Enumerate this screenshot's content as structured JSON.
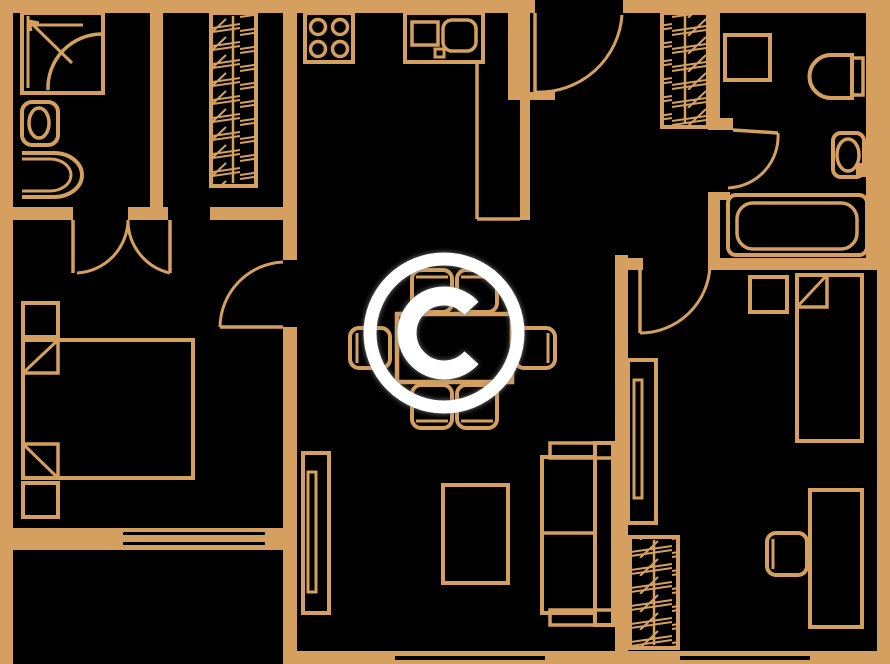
{
  "meta": {
    "watermark_letter": "C"
  },
  "colors": {
    "background": "#000000",
    "wall": "#D5A05F",
    "furniture": "#D5A05F",
    "door": "#D5A05F",
    "watermark": "#FFFFFF",
    "watermark_shadow": "#8A8A8A"
  },
  "canvas": {
    "w": 890,
    "h": 664
  },
  "walls": [
    {
      "name": "wall-top-left",
      "x": 0,
      "y": 0,
      "w": 535,
      "h": 13
    },
    {
      "name": "wall-top-right",
      "x": 623,
      "y": 0,
      "w": 267,
      "h": 13
    },
    {
      "name": "wall-left",
      "x": 0,
      "y": 0,
      "w": 13,
      "h": 664
    },
    {
      "name": "wall-right",
      "x": 877,
      "y": 0,
      "w": 13,
      "h": 664
    },
    {
      "name": "wall-right-bath-inner",
      "x": 866,
      "y": 13,
      "w": 11,
      "h": 257
    },
    {
      "name": "wall-bottom",
      "x": 297,
      "y": 651,
      "w": 593,
      "h": 13
    },
    {
      "name": "wall-bath-closet-divider",
      "x": 150,
      "y": 0,
      "w": 13,
      "h": 208
    },
    {
      "name": "wall-hall-a",
      "x": 13,
      "y": 207,
      "w": 60,
      "h": 13
    },
    {
      "name": "wall-hall-b",
      "x": 128,
      "y": 207,
      "w": 40,
      "h": 13
    },
    {
      "name": "wall-hall-c",
      "x": 210,
      "y": 207,
      "w": 87,
      "h": 13
    },
    {
      "name": "wall-kitchen-left",
      "x": 283,
      "y": 13,
      "w": 14,
      "h": 247
    },
    {
      "name": "wall-bedroom-living",
      "x": 283,
      "y": 327,
      "w": 14,
      "h": 213
    },
    {
      "name": "wall-bedroom-bottom",
      "x": 0,
      "y": 528,
      "w": 297,
      "h": 22
    },
    {
      "name": "wall-balcony-right",
      "x": 283,
      "y": 550,
      "w": 14,
      "h": 114
    },
    {
      "name": "wall-entry-pillar",
      "x": 508,
      "y": 13,
      "w": 22,
      "h": 85
    },
    {
      "name": "wall-kitchen-right",
      "x": 520,
      "y": 13,
      "w": 10,
      "h": 207
    },
    {
      "name": "wall-entry-stub",
      "x": 508,
      "y": 92,
      "w": 47,
      "h": 8
    },
    {
      "name": "wall-hall-bath-upper",
      "x": 708,
      "y": 13,
      "w": 12,
      "h": 114
    },
    {
      "name": "wall-hall-bath-lower",
      "x": 708,
      "y": 192,
      "w": 12,
      "h": 78
    },
    {
      "name": "wall-bath-partition-stub",
      "x": 708,
      "y": 118,
      "w": 25,
      "h": 12
    },
    {
      "name": "wall-bath-notch",
      "x": 720,
      "y": 192,
      "w": 10,
      "h": 8
    },
    {
      "name": "wall-rbedroom-top",
      "x": 710,
      "y": 258,
      "w": 167,
      "h": 12
    },
    {
      "name": "wall-living-rbedroom",
      "x": 615,
      "y": 255,
      "w": 13,
      "h": 409
    },
    {
      "name": "wall-rbedroom-jamb",
      "x": 615,
      "y": 258,
      "w": 28,
      "h": 12
    },
    {
      "name": "wall-bath-right-stub",
      "x": 856,
      "y": 163,
      "w": 21,
      "h": 14
    }
  ],
  "window_slits": [
    {
      "name": "window-living",
      "x": 395,
      "y": 656,
      "w": 150,
      "h": 4
    },
    {
      "name": "window-rbedroom",
      "x": 680,
      "y": 656,
      "w": 130,
      "h": 4
    },
    {
      "name": "window-balcony-upper",
      "x": 123,
      "y": 532,
      "w": 142,
      "h": 3
    },
    {
      "name": "window-balcony-lower",
      "x": 123,
      "y": 542,
      "w": 142,
      "h": 3
    }
  ],
  "doors": [
    {
      "name": "door-bathroom-left",
      "leaf": [
        73,
        220,
        73,
        273
      ],
      "arc": "M 77,273 A 54 54 0 0 0 128,220"
    },
    {
      "name": "door-closet-nook",
      "leaf": [
        170,
        220,
        170,
        273
      ],
      "arc": "M 170,273 A 54 54 0 0 1 128,220"
    },
    {
      "name": "door-bedroom-left",
      "leaf": [
        220,
        327,
        283,
        327
      ],
      "arc": "M 283,262 A 66 66 0 0 0 220,327"
    },
    {
      "name": "door-entry",
      "leaf": [
        535,
        13,
        535,
        92
      ],
      "arc": "M 536,92 A 83 83 0 0 0 622,15"
    },
    {
      "name": "door-bathroom-right",
      "leaf": [
        733,
        130,
        778,
        133
      ],
      "arc": "M 778,133 A 52 52 0 0 1 728,188"
    },
    {
      "name": "door-bedroom-right",
      "leaf": [
        640,
        270,
        640,
        333
      ],
      "arc": "M 640,333 A 70 70 0 0 0 710,266"
    }
  ],
  "furniture": [
    {
      "name": "shower",
      "type": "rect",
      "x": 22,
      "y": 13,
      "w": 81,
      "h": 80
    },
    {
      "name": "shower-glass-left",
      "type": "line",
      "x1": 28,
      "y1": 16,
      "x2": 28,
      "y2": 88,
      "sw": 3
    },
    {
      "name": "shower-glass-top",
      "type": "line",
      "x1": 28,
      "y1": 25,
      "x2": 83,
      "y2": 25,
      "sw": 3
    },
    {
      "name": "shower-arrow",
      "type": "line",
      "x1": 29,
      "y1": 21,
      "x2": 72,
      "y2": 63,
      "sw": 3
    },
    {
      "name": "shower-arrow-barb-1",
      "type": "line",
      "x1": 29,
      "y1": 21,
      "x2": 39,
      "y2": 23,
      "sw": 3
    },
    {
      "name": "shower-arrow-barb-2",
      "type": "line",
      "x1": 29,
      "y1": 21,
      "x2": 31,
      "y2": 31,
      "sw": 3
    },
    {
      "name": "shower-door-arc",
      "type": "path",
      "d": "M 102,34 A 54 54 0 0 0 48,90",
      "sw": 3.5
    },
    {
      "name": "toilet-left",
      "type": "rect",
      "x": 22,
      "y": 102,
      "w": 36,
      "h": 43,
      "rx": 10
    },
    {
      "name": "toilet-left-bowl",
      "type": "ellipse",
      "cx": 39,
      "cy": 123,
      "rx": 10,
      "ry": 15,
      "sw": 3.5
    },
    {
      "name": "sink-left",
      "type": "path",
      "d": "M 22,153 h 32 a 28 22 0 0 1 0 44 h -32",
      "sw": 4
    },
    {
      "name": "sink-left-inner",
      "type": "path",
      "d": "M 22,159 h 28 a 21 16 0 0 1 0 32 h -28",
      "sw": 3
    },
    {
      "name": "wardrobe-hall-left",
      "type": "hrect",
      "x": 211,
      "y": 13,
      "w": 45,
      "h": 173
    },
    {
      "name": "wardrobe-hall-left-rod",
      "type": "line",
      "x1": 233,
      "y1": 16,
      "x2": 233,
      "y2": 183,
      "sw": 2.5
    },
    {
      "name": "wardrobe-entry",
      "type": "hrect",
      "x": 662,
      "y": 13,
      "w": 46,
      "h": 114
    },
    {
      "name": "wardrobe-entry-rod",
      "type": "line",
      "x1": 685,
      "y1": 15,
      "x2": 685,
      "y2": 124,
      "sw": 2.5
    },
    {
      "name": "wardrobe-rbedroom",
      "type": "hrect",
      "x": 630,
      "y": 537,
      "w": 48,
      "h": 111
    },
    {
      "name": "wardrobe-rbedroom-rod",
      "type": "line",
      "x1": 654,
      "y1": 540,
      "x2": 654,
      "y2": 645,
      "sw": 2.5
    },
    {
      "name": "stove",
      "type": "rect",
      "x": 305,
      "y": 13,
      "w": 48,
      "h": 49
    },
    {
      "name": "stove-burner-1",
      "type": "circle",
      "cx": 318,
      "cy": 27,
      "r": 7.5,
      "sw": 3.5
    },
    {
      "name": "stove-burner-2",
      "type": "circle",
      "cx": 340,
      "cy": 27,
      "r": 7.5,
      "sw": 3.5
    },
    {
      "name": "stove-burner-3",
      "type": "circle",
      "cx": 318,
      "cy": 49,
      "r": 7.5,
      "sw": 3.5
    },
    {
      "name": "stove-burner-4",
      "type": "circle",
      "cx": 340,
      "cy": 49,
      "r": 7.5,
      "sw": 3.5
    },
    {
      "name": "kitchen-sink-unit",
      "type": "rect",
      "x": 405,
      "y": 13,
      "w": 78,
      "h": 49
    },
    {
      "name": "kitchen-counter-square",
      "type": "rect",
      "x": 412,
      "y": 22,
      "w": 26,
      "h": 23,
      "sw": 3.5
    },
    {
      "name": "kitchen-sink-basin",
      "type": "rect",
      "x": 443,
      "y": 20,
      "w": 33,
      "h": 31,
      "rx": 9,
      "sw": 3.5
    },
    {
      "name": "kitchen-sink-tap",
      "type": "rect",
      "x": 435,
      "y": 49,
      "w": 9,
      "h": 8,
      "sw": 3
    },
    {
      "name": "kitchen-counter-edge-v",
      "type": "line",
      "x1": 477,
      "y1": 62,
      "x2": 477,
      "y2": 219,
      "sw": 3.5
    },
    {
      "name": "kitchen-counter-edge-h",
      "type": "line",
      "x1": 477,
      "y1": 219,
      "x2": 520,
      "y2": 219,
      "sw": 3.5
    },
    {
      "name": "dining-table",
      "type": "rect",
      "x": 397,
      "y": 314,
      "w": 115,
      "h": 68,
      "sw": 4.5
    },
    {
      "name": "chair-top-1",
      "type": "rect",
      "x": 412,
      "y": 270,
      "w": 40,
      "h": 42,
      "rx": 9
    },
    {
      "name": "chair-top-1-back",
      "type": "line",
      "x1": 416,
      "y1": 277,
      "x2": 448,
      "y2": 277,
      "sw": 3
    },
    {
      "name": "chair-top-2",
      "type": "rect",
      "x": 457,
      "y": 270,
      "w": 40,
      "h": 42,
      "rx": 9
    },
    {
      "name": "chair-top-2-back",
      "type": "line",
      "x1": 461,
      "y1": 277,
      "x2": 493,
      "y2": 277,
      "sw": 3
    },
    {
      "name": "chair-bottom-1",
      "type": "rect",
      "x": 412,
      "y": 385,
      "w": 40,
      "h": 43,
      "rx": 9
    },
    {
      "name": "chair-bottom-1-back",
      "type": "line",
      "x1": 416,
      "y1": 421,
      "x2": 448,
      "y2": 421,
      "sw": 3
    },
    {
      "name": "chair-bottom-2",
      "type": "rect",
      "x": 457,
      "y": 385,
      "w": 40,
      "h": 43,
      "rx": 9
    },
    {
      "name": "chair-bottom-2-back",
      "type": "line",
      "x1": 461,
      "y1": 421,
      "x2": 493,
      "y2": 421,
      "sw": 3
    },
    {
      "name": "chair-left",
      "type": "rect",
      "x": 350,
      "y": 328,
      "w": 40,
      "h": 40,
      "rx": 9
    },
    {
      "name": "chair-left-back",
      "type": "line",
      "x1": 357,
      "y1": 333,
      "x2": 357,
      "y2": 363,
      "sw": 3
    },
    {
      "name": "chair-right",
      "type": "rect",
      "x": 515,
      "y": 328,
      "w": 40,
      "h": 40,
      "rx": 9
    },
    {
      "name": "chair-right-back",
      "type": "line",
      "x1": 548,
      "y1": 333,
      "x2": 548,
      "y2": 363,
      "sw": 3
    },
    {
      "name": "tv-stand",
      "type": "rect",
      "x": 303,
      "y": 453,
      "w": 26,
      "h": 160
    },
    {
      "name": "tv",
      "type": "rect",
      "x": 308,
      "y": 472,
      "w": 8,
      "h": 120,
      "sw": 3
    },
    {
      "name": "coffee-table",
      "type": "rect",
      "x": 443,
      "y": 485,
      "w": 65,
      "h": 98
    },
    {
      "name": "sofa-back",
      "type": "rect",
      "x": 595,
      "y": 443,
      "w": 18,
      "h": 182
    },
    {
      "name": "sofa-arm-top",
      "type": "rect",
      "x": 550,
      "y": 443,
      "w": 63,
      "h": 15,
      "sw": 3.5
    },
    {
      "name": "sofa-arm-bottom",
      "type": "rect",
      "x": 550,
      "y": 610,
      "w": 63,
      "h": 15,
      "sw": 3.5
    },
    {
      "name": "sofa-seat",
      "type": "rect",
      "x": 542,
      "y": 457,
      "w": 53,
      "h": 156
    },
    {
      "name": "sofa-seat-divider",
      "type": "line",
      "x1": 542,
      "y1": 533,
      "x2": 595,
      "y2": 533,
      "sw": 3.5
    },
    {
      "name": "bed-right",
      "type": "rect",
      "x": 797,
      "y": 275,
      "w": 65,
      "h": 166
    },
    {
      "name": "pillow-right",
      "type": "rect",
      "x": 797,
      "y": 275,
      "w": 30,
      "h": 32,
      "sw": 3.5
    },
    {
      "name": "pillow-right-fold",
      "type": "line",
      "x1": 797,
      "y1": 307,
      "x2": 827,
      "y2": 275,
      "sw": 3
    },
    {
      "name": "nightstand-right",
      "type": "rect",
      "x": 750,
      "y": 277,
      "w": 37,
      "h": 35
    },
    {
      "name": "desk",
      "type": "rect",
      "x": 810,
      "y": 490,
      "w": 52,
      "h": 137
    },
    {
      "name": "desk-chair",
      "type": "rect",
      "x": 767,
      "y": 533,
      "w": 40,
      "h": 42,
      "rx": 9
    },
    {
      "name": "desk-chair-back",
      "type": "line",
      "x1": 773,
      "y1": 539,
      "x2": 773,
      "y2": 569,
      "sw": 3
    },
    {
      "name": "shelf-rbedroom",
      "type": "rect",
      "x": 628,
      "y": 360,
      "w": 28,
      "h": 163
    },
    {
      "name": "shelf-rbedroom-inner",
      "type": "rect",
      "x": 634,
      "y": 380,
      "w": 8,
      "h": 118,
      "sw": 3
    },
    {
      "name": "washing-machine",
      "type": "rect",
      "x": 725,
      "y": 35,
      "w": 45,
      "h": 45
    },
    {
      "name": "toilet-right",
      "type": "path",
      "d": "M 852,55 h -21 a 21 21 0 0 0 0 43 h 21 z",
      "sw": 4
    },
    {
      "name": "toilet-right-tank",
      "type": "rect",
      "x": 852,
      "y": 58,
      "w": 11,
      "h": 37,
      "sw": 3.5
    },
    {
      "name": "sink-right",
      "type": "rect",
      "x": 833,
      "y": 133,
      "w": 31,
      "h": 44,
      "rx": 8
    },
    {
      "name": "sink-right-bowl",
      "type": "ellipse",
      "cx": 848,
      "cy": 155,
      "rx": 11,
      "ry": 16,
      "sw": 3.5
    },
    {
      "name": "bathtub",
      "type": "rect",
      "x": 728,
      "y": 195,
      "w": 139,
      "h": 60,
      "rx": 8
    },
    {
      "name": "bathtub-inner",
      "type": "rect",
      "x": 737,
      "y": 203,
      "w": 120,
      "h": 46,
      "rx": 16,
      "sw": 3.5
    },
    {
      "name": "nightstand-left-1",
      "type": "rect",
      "x": 23,
      "y": 303,
      "w": 35,
      "h": 34
    },
    {
      "name": "bed-left",
      "type": "rect",
      "x": 23,
      "y": 340,
      "w": 170,
      "h": 138
    },
    {
      "name": "pillow-left-1",
      "type": "rect",
      "x": 23,
      "y": 340,
      "w": 35,
      "h": 33,
      "sw": 3.5
    },
    {
      "name": "pillow-left-1-fold",
      "type": "line",
      "x1": 23,
      "y1": 373,
      "x2": 58,
      "y2": 340,
      "sw": 3
    },
    {
      "name": "pillow-left-2",
      "type": "rect",
      "x": 23,
      "y": 444,
      "w": 35,
      "h": 34,
      "sw": 3.5
    },
    {
      "name": "pillow-left-2-fold",
      "type": "line",
      "x1": 23,
      "y1": 444,
      "x2": 58,
      "y2": 478,
      "sw": 3
    },
    {
      "name": "nightstand-left-2",
      "type": "rect",
      "x": 23,
      "y": 483,
      "w": 35,
      "h": 34
    }
  ],
  "watermark": {
    "cx": 444,
    "cy": 333,
    "ring_r": 74,
    "ring_sw": 13,
    "c_r": 37,
    "c_sw": 19,
    "gap_deg": 42
  }
}
